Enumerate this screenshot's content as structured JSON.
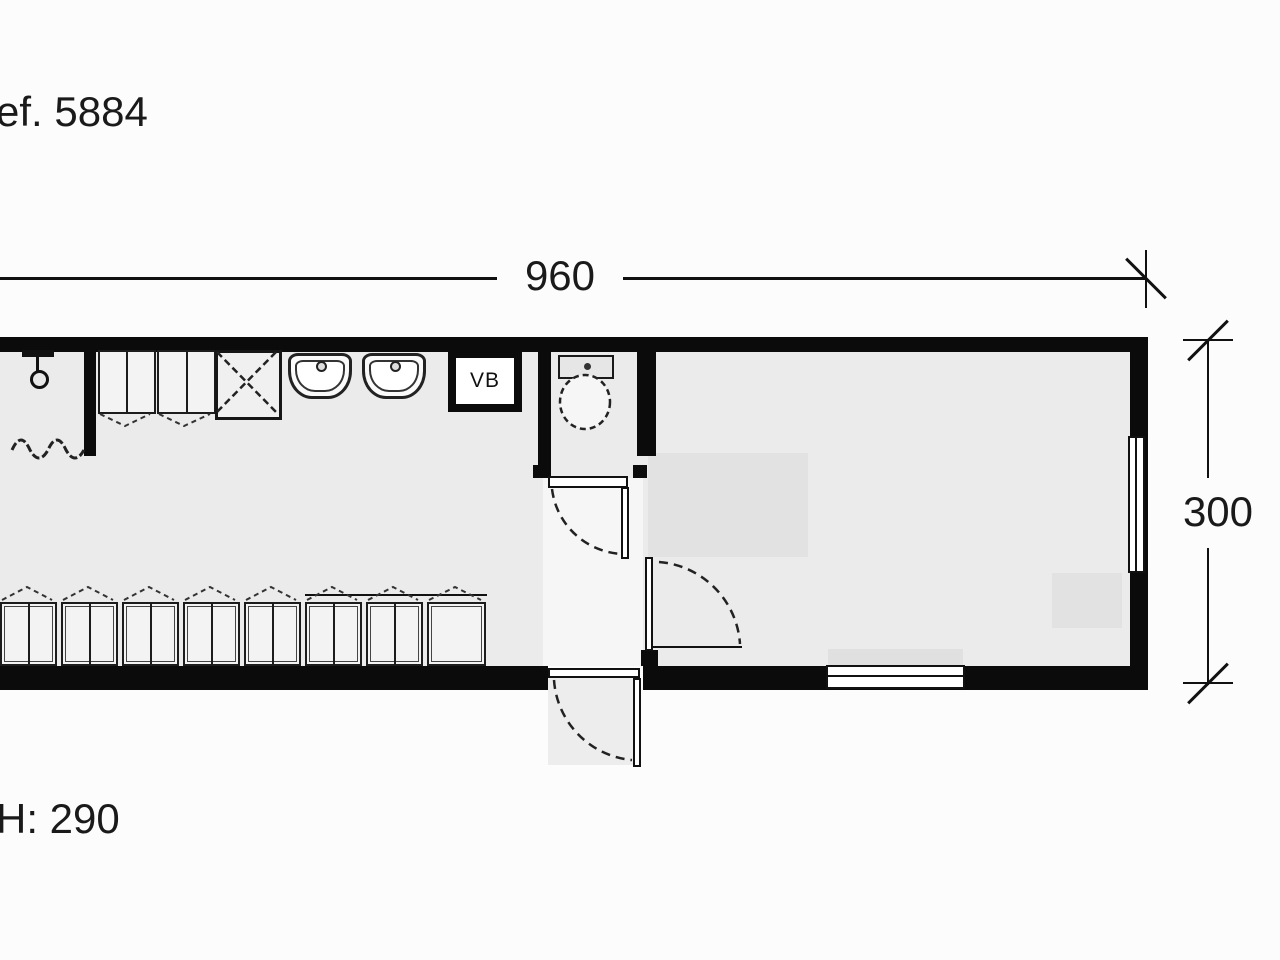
{
  "title": "Floor plan drawing",
  "labels": {
    "reference": "ef. 5884",
    "ceiling_height": "H: 290"
  },
  "dimensions": {
    "width": "960",
    "depth": "300"
  },
  "fixtures": {
    "water_heater": "VB"
  },
  "colors": {
    "background": "#fcfcfc",
    "wall": "#0b0b0b",
    "floor": "#ebebeb",
    "furniture_shadow": "#e2e2e2",
    "line": "#111111"
  },
  "icons": [
    "shower-icon",
    "sink-icon",
    "toilet-icon",
    "locker-icon",
    "door-swing-icon",
    "window-icon",
    "dimension-tick-icon"
  ]
}
